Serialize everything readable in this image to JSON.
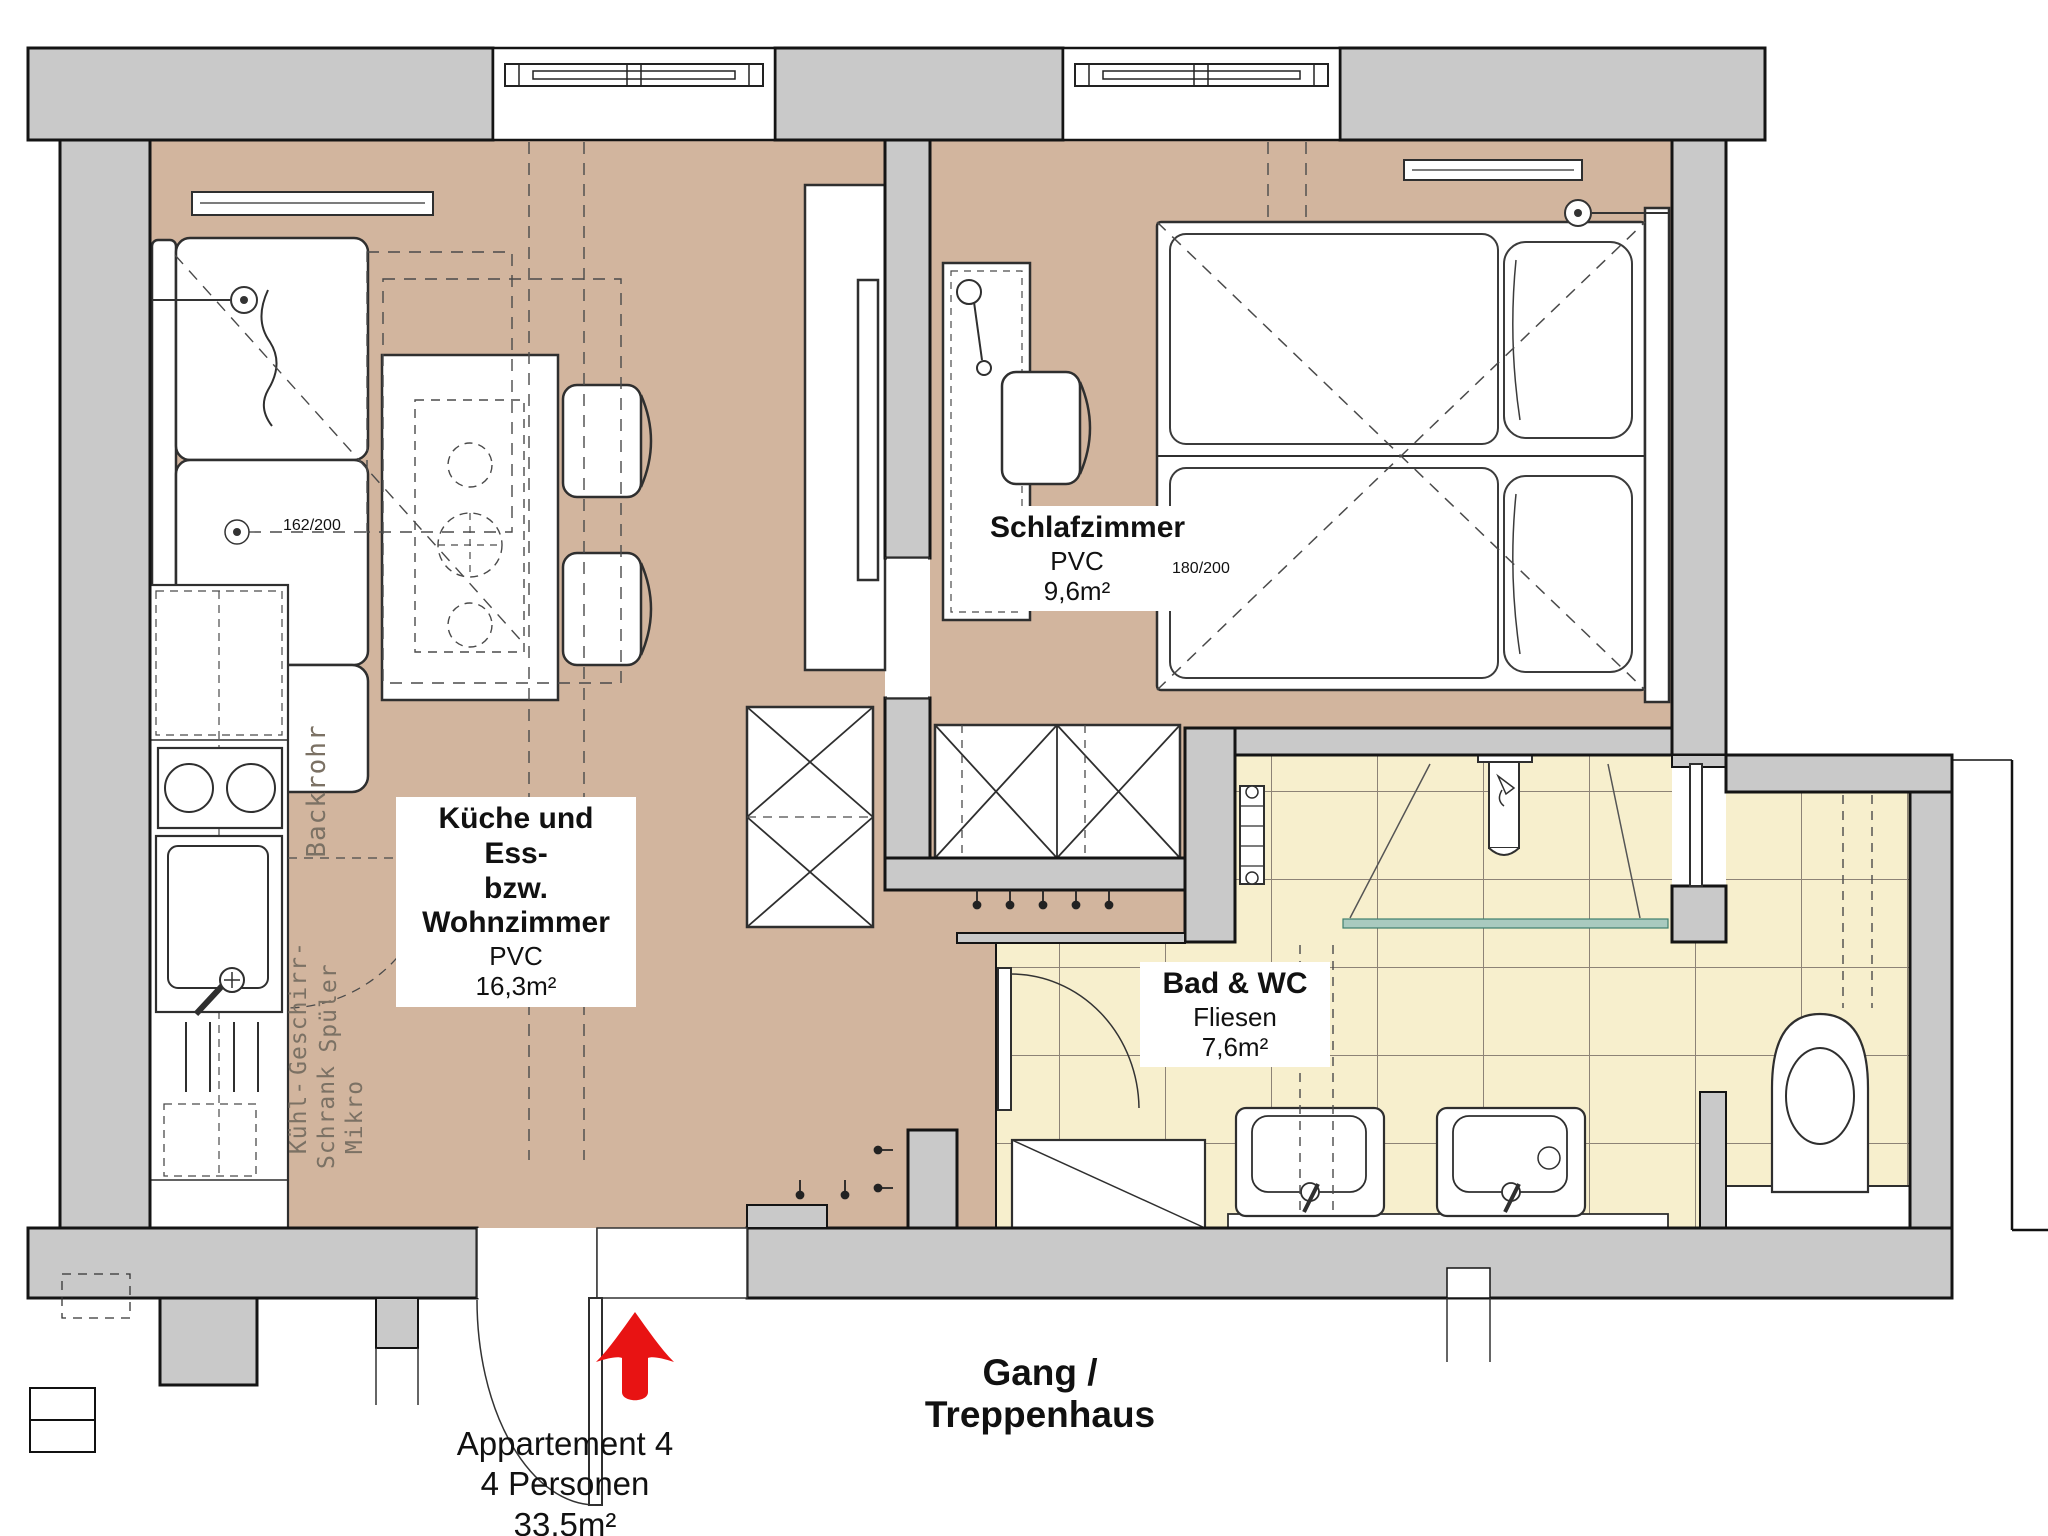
{
  "plan": {
    "apartment": {
      "name": "Appartement 4",
      "capacity": "4 Personen",
      "area": "33,5m²"
    },
    "corridor": {
      "label": "Gang / Treppenhaus"
    },
    "rooms": {
      "living": {
        "name_line1": "Küche und Ess-",
        "name_line2": "bzw. Wohnzimmer",
        "floor": "PVC",
        "area": "16,3m²"
      },
      "bedroom": {
        "name": "Schlafzimmer",
        "floor": "PVC",
        "area": "9,6m²"
      },
      "bath": {
        "name": "Bad & WC",
        "floor": "Fliesen",
        "area": "7,6m²"
      }
    },
    "kitchen_labels": {
      "oven": "Backrohr",
      "dishwasher_line1": "Geschirr-",
      "dishwasher_line2": "Spüler",
      "fridge_line1": "Kühl-",
      "fridge_line2": "Schrank",
      "fridge_line3": "Mikro"
    },
    "dimensions": {
      "sofa_bed": "162/200",
      "double_bed": "180/200"
    },
    "icons": {
      "entrance_arrow": "red-up-arrow"
    },
    "colors": {
      "floor_tan": "#d2b59e",
      "tile": "#f7efcd",
      "grout": "#8d8376",
      "wall": "#c9c9c9",
      "accent_red": "#e81313",
      "glass_teal": "#a9cabf"
    }
  }
}
